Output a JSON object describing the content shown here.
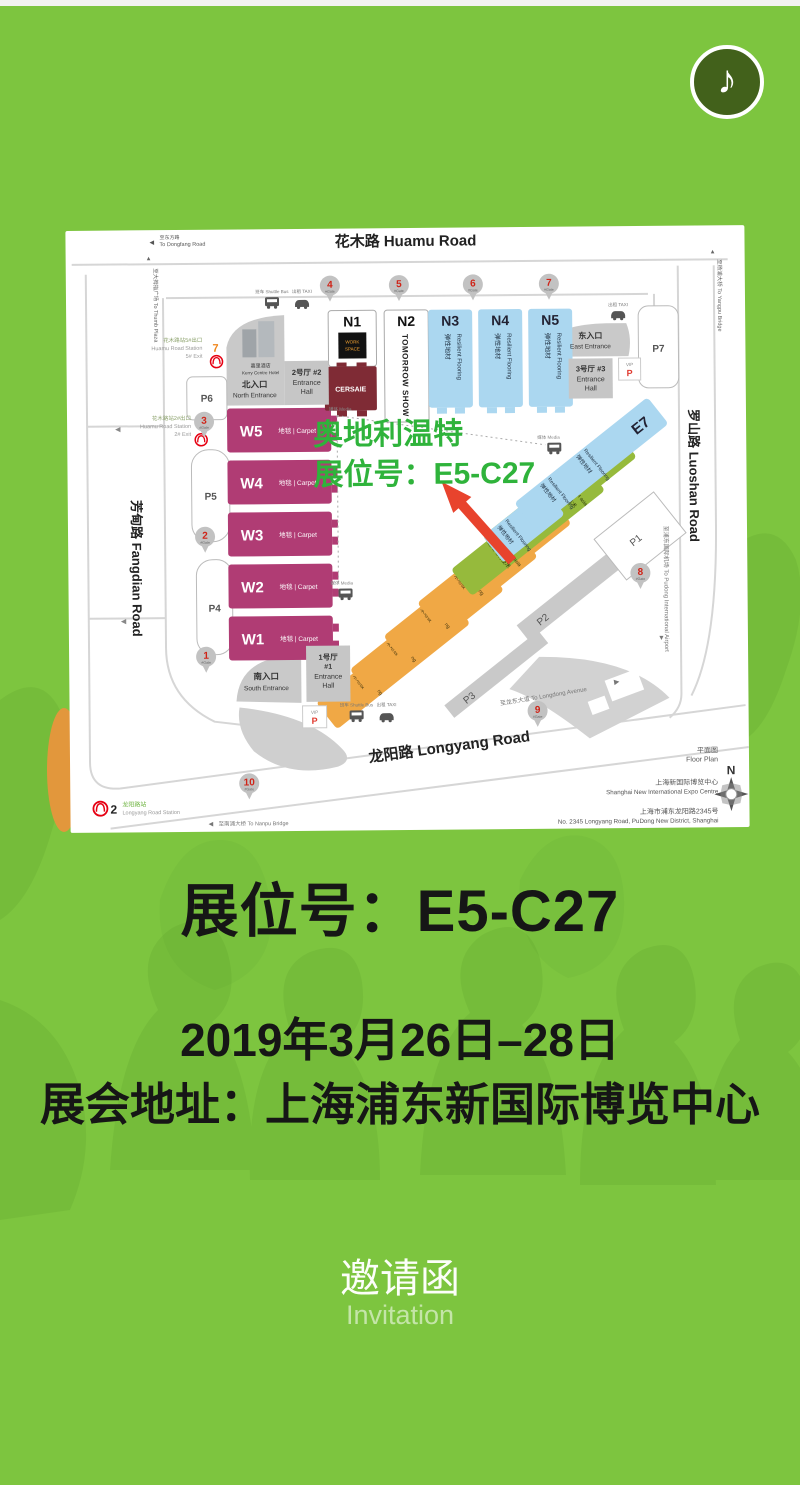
{
  "icons": {
    "music_note": "♪",
    "left_arrow": "◀",
    "up_arrow": "▲",
    "down_arrow": "▼",
    "right_arrow": "▶"
  },
  "booth": {
    "title": "展位号：E5-C27",
    "date": "2019年3月26日–28日",
    "address": "展会地址：上海浦东新国际博览中心"
  },
  "footer": {
    "title_zh": "邀请函",
    "title_en": "Invitation"
  },
  "map": {
    "overlay": {
      "line1": "奥地利温特",
      "line2": "展位号：E5-C27",
      "color": "#2fb33b"
    },
    "roads": {
      "huamu": "花木路 Huamu Road",
      "luoshan": "罗山路 Luoshan Road",
      "fangdian": "芳甸路 Fangdian Road",
      "longyang": "龙阳路 Longyang Road",
      "to_dongfang_zh": "至东方路",
      "to_dongfang_en": "To Dongfang Road",
      "to_thumb_plaza": "至大拇指广场 To Thumb Plaza",
      "to_yangpu_bridge": "至杨浦大桥 To Yangpu Bridge",
      "to_pudong_airport": "至浦东国际机场 To Pudong International Airport",
      "to_longdong_avenue": "至龙东大道 To Longdong Avenue",
      "to_nanpu_bridge": "至南浦大桥 To Nanpu Bridge"
    },
    "gates": [
      "1",
      "2",
      "3",
      "4",
      "5",
      "6",
      "7",
      "8",
      "9",
      "10"
    ],
    "gate_sub": "#Gate",
    "stations": {
      "huamu5_line": "7",
      "huamu5_zh": "花木路站5#出口",
      "huamu5_en": "Huamu Road Station",
      "huamu5_exit": "5# Exit",
      "huamu2_line": "7",
      "huamu2_zh": "花木路站2#出口",
      "huamu2_en": "Huamu Road Station",
      "huamu2_exit": "2# Exit",
      "longyang_line": "2",
      "longyang_zh": "龙阳路站",
      "longyang_en": "Longyang Road Station"
    },
    "entrances": {
      "north_zh": "北入口",
      "north_en": "North Entrance",
      "south_zh": "南入口",
      "south_en": "South Entrance",
      "east_zh": "东入口",
      "east_en": "East Entrance",
      "hall1_zh": "1号厅",
      "hall1_no": "#1",
      "hall2_zh": "2号厅 #2",
      "hall3_zh": "3号厅 #3",
      "hall_en1": "Entrance",
      "hall_en2": "Hall"
    },
    "hotel": {
      "zh": "嘉里酒店",
      "en": "Kerry Centre Hotel"
    },
    "halls": {
      "w": [
        {
          "id": "W5",
          "sub": "地毯 | Carpet"
        },
        {
          "id": "W4",
          "sub": "地毯 | Carpet"
        },
        {
          "id": "W3",
          "sub": "地毯 | Carpet"
        },
        {
          "id": "W2",
          "sub": "地毯 | Carpet"
        },
        {
          "id": "W1",
          "sub": "地毯 | Carpet"
        }
      ],
      "n1": {
        "id": "N1",
        "logo_line1": "WORK",
        "logo_line2": "SPACE",
        "brand": "CERSAIE"
      },
      "n2": {
        "id": "N2",
        "brand": "TOMORROW SHOW"
      },
      "n_blue": [
        {
          "id": "N3",
          "zh": "弹性地材",
          "en": "Resilient Flooring"
        },
        {
          "id": "N4",
          "zh": "弹性地材",
          "en": "Resilient Flooring"
        },
        {
          "id": "N5",
          "zh": "弹性地材",
          "en": "Resilient Flooring"
        }
      ],
      "e": [
        {
          "id": "E1",
          "zh": "木地板",
          "en": "Wood Flooring"
        },
        {
          "id": "E2",
          "zh": "木地板",
          "en": "Wood Flooring"
        },
        {
          "id": "E3",
          "zh": "木地板",
          "en": "Wood Flooring"
        },
        {
          "id": "E4",
          "zh": "木地板",
          "en": "Wood Flooring"
        },
        {
          "id": "E5",
          "zh": "运动地材技术",
          "en": "SPORTECH asia"
        },
        {
          "id": "E6",
          "zh": "运动地材技术",
          "en": "SPORTECH asia",
          "zh2": "弹性地材",
          "en2": "Resilient Flooring"
        },
        {
          "id": "E7",
          "zh": "弹性地材",
          "en": "Resilient Flooring"
        }
      ]
    },
    "parking": {
      "p1": "P1",
      "p2": "P2",
      "p3": "P3",
      "p4": "P4",
      "p5": "P5",
      "p6": "P6",
      "p7": "P7"
    },
    "labels": {
      "vip": "VIP",
      "p": "P",
      "shuttle": "班车 Shuttle Bus",
      "taxi": "出租 TAXI",
      "media": "媒体 Media"
    },
    "legend": {
      "floorplan_zh": "平面图",
      "floorplan_en": "Floor Plan",
      "venue_zh": "上海新国际博览中心",
      "venue_en": "Shanghai New International Expo Centre",
      "addr_zh": "上海市浦东龙阳路2345号",
      "addr_en": "No. 2345 Longyang Road, PuDong New District, Shanghai",
      "compass_n": "N"
    }
  }
}
